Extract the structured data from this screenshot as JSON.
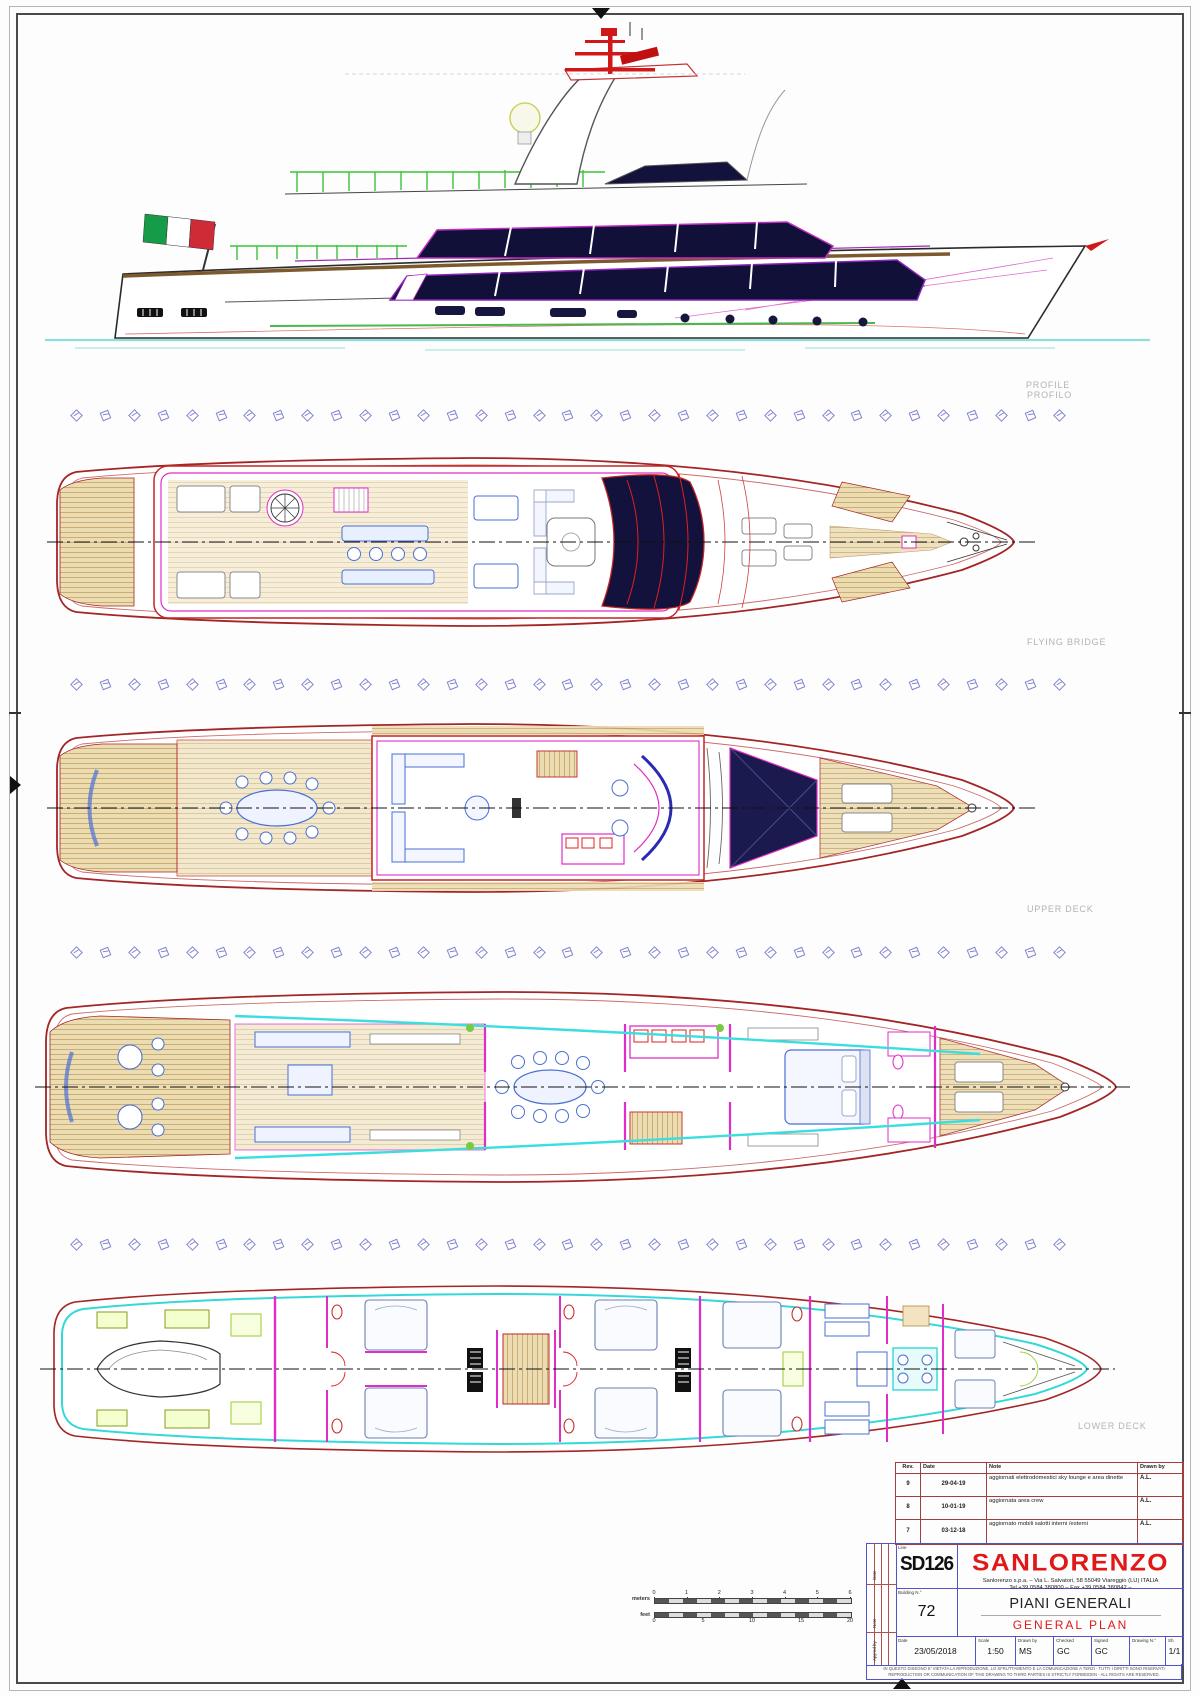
{
  "deck_labels": {
    "profile": "PROFILE",
    "profilo": "PROFILO",
    "flying_bridge": "FLYING BRIDGE",
    "upper_deck": "UPPER DECK",
    "lower_deck": "LOWER DECK"
  },
  "scale_bar": {
    "meters_label": "meters",
    "feet_label": "feet",
    "meters_ticks": [
      "0",
      "1",
      "2",
      "3",
      "4",
      "5",
      "6"
    ],
    "feet_ticks": [
      "0",
      "5",
      "10",
      "15",
      "20"
    ]
  },
  "title_block": {
    "revisions": {
      "headers": {
        "rev": "Rev.",
        "date": "Date",
        "note": "Note",
        "drawn_by": "Drawn by"
      },
      "rows": [
        {
          "rev": "9",
          "date": "29-04-19",
          "note": "aggiornati elettrodomestici sky lounge e area dinette",
          "drawn_by": "A.L."
        },
        {
          "rev": "8",
          "date": "10-01-19",
          "note": "aggiornata area crew",
          "drawn_by": "A.L."
        },
        {
          "rev": "7",
          "date": "03-12-18",
          "note": "aggiornato mobili salotti interni /esterni",
          "drawn_by": "A.L."
        }
      ]
    },
    "line_label": "Line",
    "line_value": "SD126",
    "brand": {
      "name": "SANLORENZO",
      "address": "Sanlorenzo s.p.a.  –  Via L. Salvatori, 58 55049 Viareggio (LU) ITALIA",
      "contacts": "Tel.+39 0584 380800  –  Fax +39 0584 380842  –"
    },
    "building_label": "Building N.°",
    "building_value": "72",
    "title_it": "PIANI GENERALI",
    "title_en": "GENERAL PLAN",
    "side_labels": {
      "top": "Date",
      "mid": "Note",
      "bottom": "App'ed by"
    },
    "bottom_fields": [
      {
        "label": "Date",
        "value": "23/05/2018"
      },
      {
        "label": "Scale",
        "value": "1:50"
      },
      {
        "label": "Drawn by",
        "value": "MS"
      },
      {
        "label": "Checked",
        "value": "GC"
      },
      {
        "label": "Signed",
        "value": "GC"
      },
      {
        "label": "Drawing N.°",
        "value": ""
      },
      {
        "label": "Sh.",
        "value": "1/1"
      }
    ],
    "disclaimer_it": "IN QUESTO DISEGNO E' VIETATA LA RIPRODUZIONE, LO SFRUTTAMENTO E LA COMUNICAZIONE A TERZI  -  TUTTI I DIRITTI SONO RISERVATI",
    "disclaimer_en": "REPRODUCTION OR COMMUNICATION OF THIS DRAWING TO THIRD PARTIES IS STRICTLY FORBIDDEN  -  ALL RIGHTS ARE RESERVED."
  },
  "colors": {
    "hull_outline": "#a32525",
    "walls_magenta": "#e02cc8",
    "furniture_blue": "#4a6fd4",
    "glazing_navy": "#12123c",
    "teak": "#ecdcb2",
    "cyan_accent": "#35d8d8",
    "brand_red": "#e01818",
    "marker_purple": "#8285d2",
    "flag": [
      "#169b48",
      "#ffffff",
      "#ce2b37"
    ]
  },
  "frame_markers": {
    "rows": 4,
    "per_row": 35
  }
}
